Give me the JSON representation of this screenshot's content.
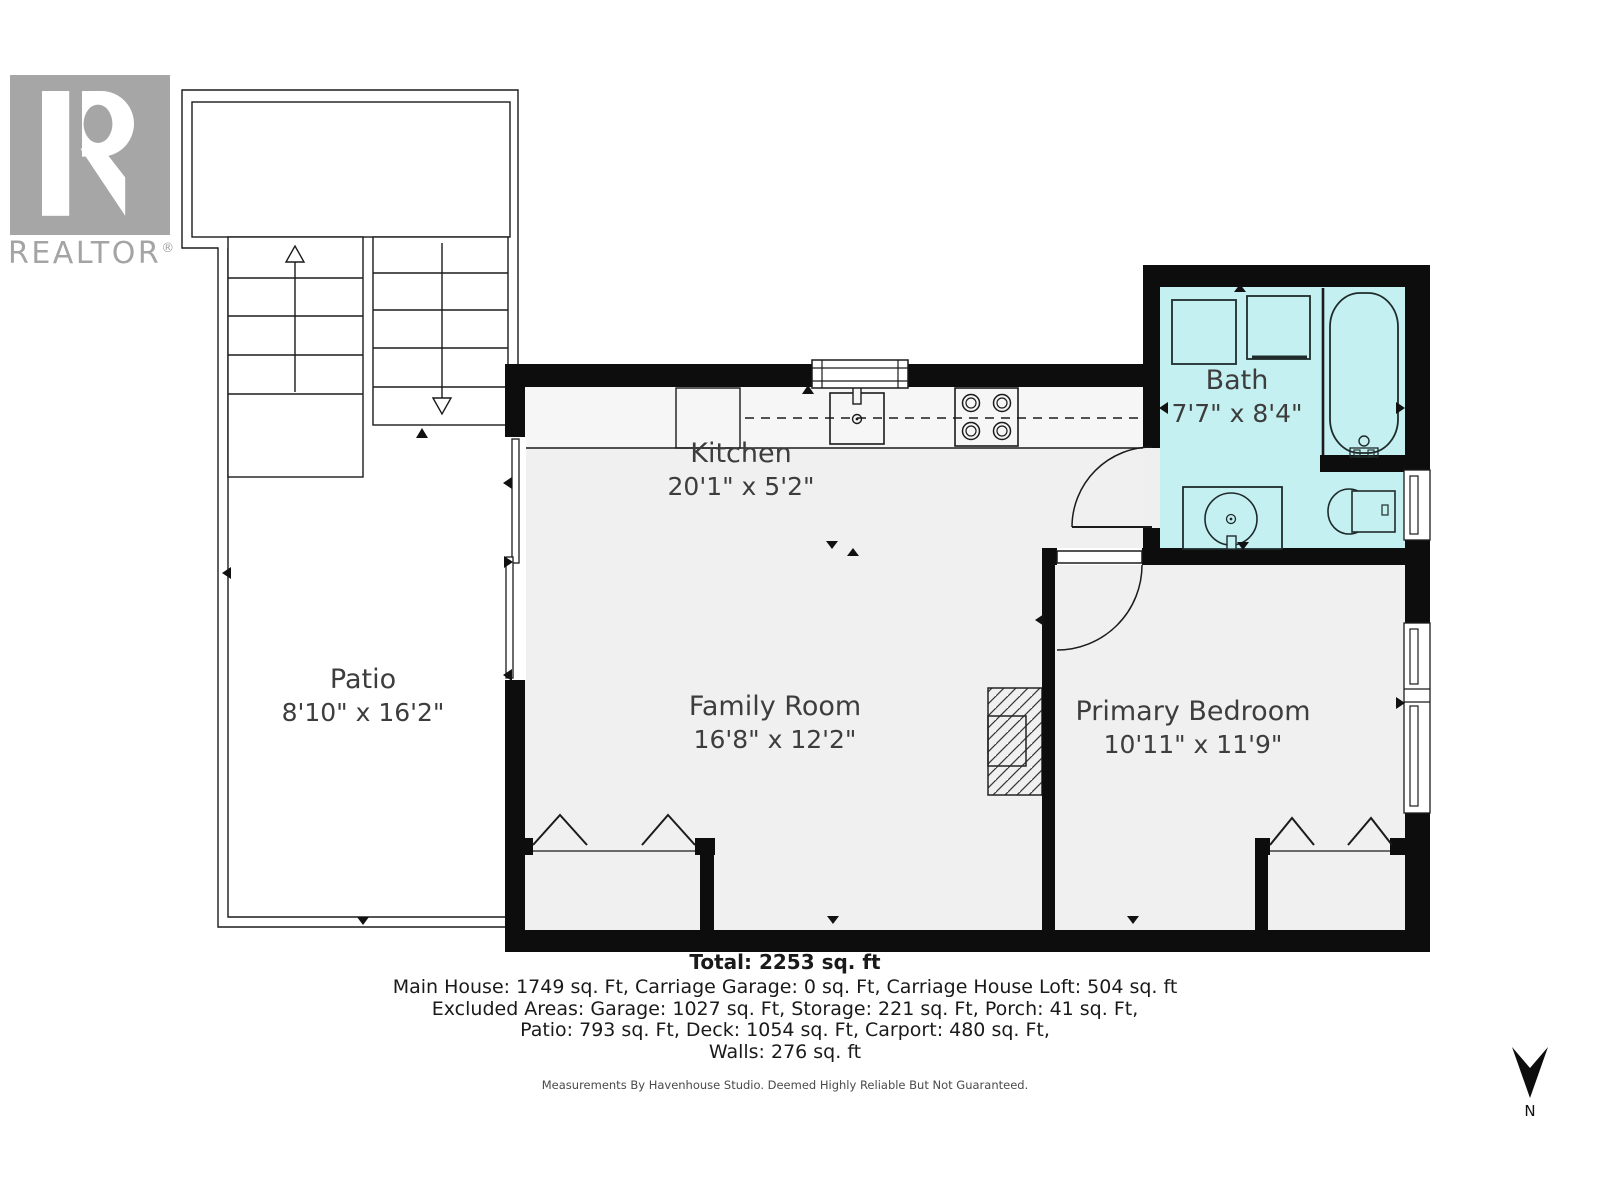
{
  "branding": {
    "name": "REALTOR",
    "reg": "®"
  },
  "rooms": {
    "patio": {
      "name": "Patio",
      "dims": "8'10\" x 16'2\""
    },
    "kitchen": {
      "name": "Kitchen",
      "dims": "20'1\" x 5'2\""
    },
    "family": {
      "name": "Family Room",
      "dims": "16'8\" x 12'2\""
    },
    "bath": {
      "name": "Bath",
      "dims": "7'7\" x 8'4\""
    },
    "bedroom": {
      "name": "Primary Bedroom",
      "dims": "10'11\" x 11'9\""
    }
  },
  "summary": {
    "total": "Total: 2253 sq. ft",
    "line1": "Main House: 1749 sq. Ft, Carriage Garage: 0 sq. Ft, Carriage House Loft: 504 sq. ft",
    "line2": "Excluded Areas: Garage: 1027 sq. Ft, Storage: 221 sq. Ft, Porch: 41 sq. Ft,",
    "line3": "Patio: 793 sq. Ft, Deck: 1054 sq. Ft, Carport: 480 sq. Ft,",
    "line4": "Walls: 276 sq. ft"
  },
  "disclaimer": "Measurements By Havenhouse Studio. Deemed Highly Reliable But Not Guaranteed.",
  "compass": {
    "label": "N"
  },
  "colors": {
    "bath_fill": "#c4f0f1",
    "floor_fill": "#f0f0f0",
    "counter_fill": "#f6f6f6",
    "wall": "#0d0d0d",
    "line": "#1b1b1b",
    "logo_gray": "#a6a6a6"
  }
}
